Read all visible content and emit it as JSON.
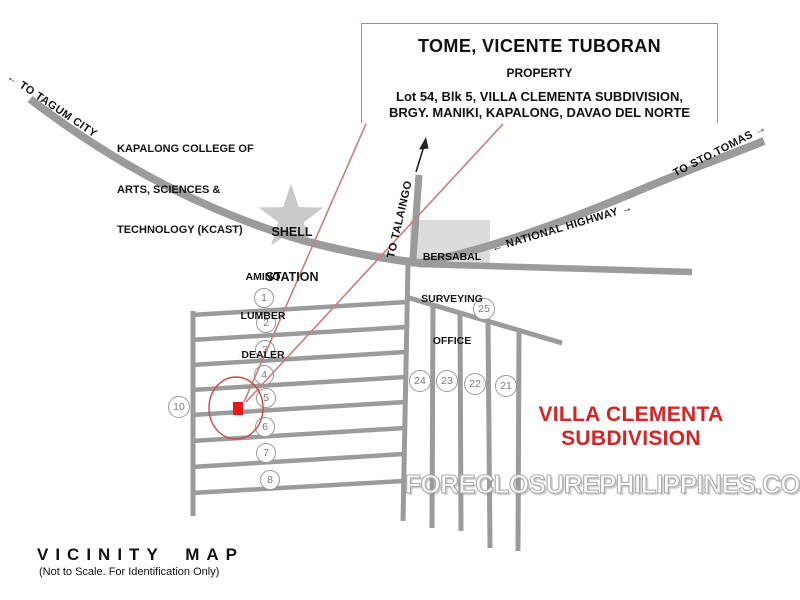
{
  "callout": {
    "title": "TOME, VICENTE TUBORAN",
    "subtitle": "PROPERTY",
    "address_line1": "Lot 54, Blk 5, VILLA CLEMENTA SUBDIVISION,",
    "address_line2": "BRGY. MANIKI, KAPALONG, DAVAO DEL NORTE"
  },
  "road_labels": {
    "to_tagum_city": "← TO TAGUM CITY",
    "to_sto_tomas": "TO STO.TOMAS →",
    "national_highway": "← NATIONAL HIGHWAY →",
    "to_talaingo": "TO TALAINGO"
  },
  "landmarks": {
    "kcast_line1": "KAPALONG COLLEGE OF",
    "kcast_line2": "ARTS, SCIENCES &",
    "kcast_line3": "TECHNOLOGY (KCAST)",
    "shell_line1": "SHELL",
    "shell_line2": "STATION",
    "amino_line1": "AMINO",
    "amino_line2": "LUMBER",
    "amino_line3": "DEALER",
    "bersabal_line1": "BERSABAL",
    "bersabal_line2": "SURVEYING",
    "bersabal_line3": "OFFICE"
  },
  "subdivision": {
    "name_line1": "VILLA CLEMENTA",
    "name_line2": "SUBDIVISION",
    "blocks": {
      "n1": "1",
      "n2": "2",
      "n3": "3",
      "n4": "4",
      "n5": "5",
      "n6": "6",
      "n7": "7",
      "n8": "8",
      "n10": "10",
      "n21": "21",
      "n22": "22",
      "n23": "23",
      "n24": "24",
      "n25": "25"
    }
  },
  "watermark": "FORECLOSUREPHILIPPINES.COM",
  "footer": {
    "title": "VICINITY MAP",
    "note": "(Not to Scale. For Identification Only)"
  },
  "colors": {
    "road_gray": "#9b9b9b",
    "landmark_gray": "#cacaca",
    "circle_border": "#9a9a9a",
    "callout_border": "#c87f7f",
    "marker_red": "#ed1515",
    "subdivision_red": "#d32525",
    "watermark_gray": "#ababab"
  }
}
